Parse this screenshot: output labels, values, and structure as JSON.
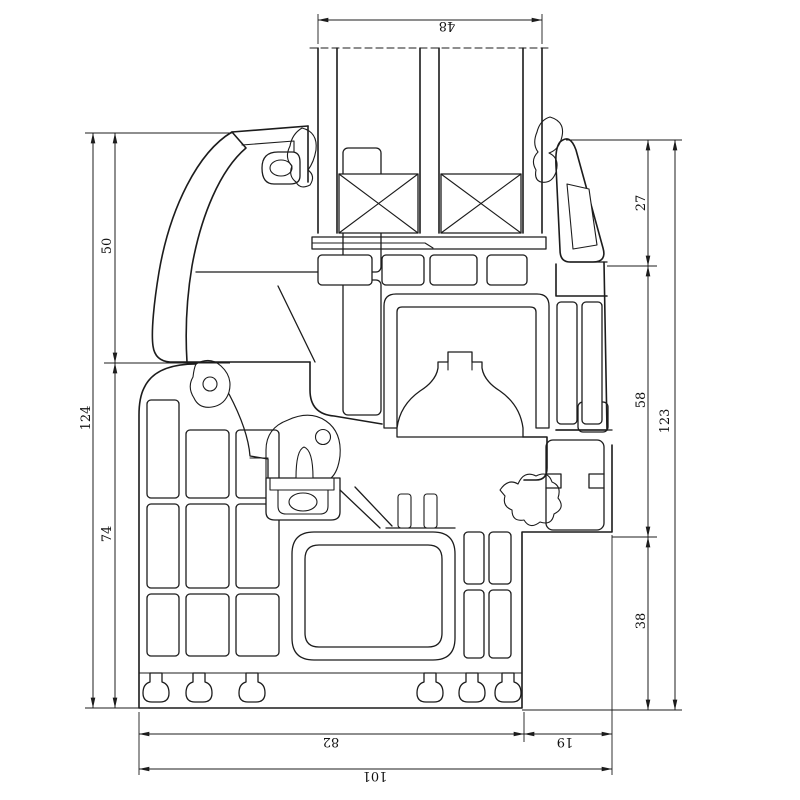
{
  "drawing": {
    "dimensions": {
      "top_glazing": "48",
      "left_upper": "50",
      "left_lower": "74",
      "left_overall": "124",
      "right_upper": "27",
      "right_middle": "58",
      "right_lower": "38",
      "right_overall": "123",
      "bottom_main": "82",
      "bottom_right": "19",
      "bottom_overall": "101"
    },
    "colors": {
      "line": "#1c1c1c",
      "background": "#ffffff"
    }
  }
}
